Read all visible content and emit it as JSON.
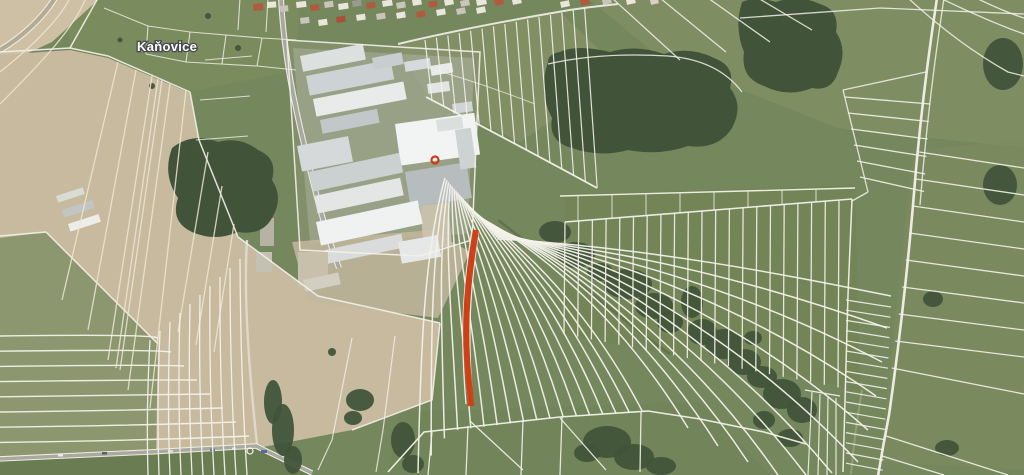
{
  "map": {
    "place_label": "Kaňovice",
    "highlight_color": "#cf3d16",
    "boundary_color": "#f3f1ea"
  }
}
